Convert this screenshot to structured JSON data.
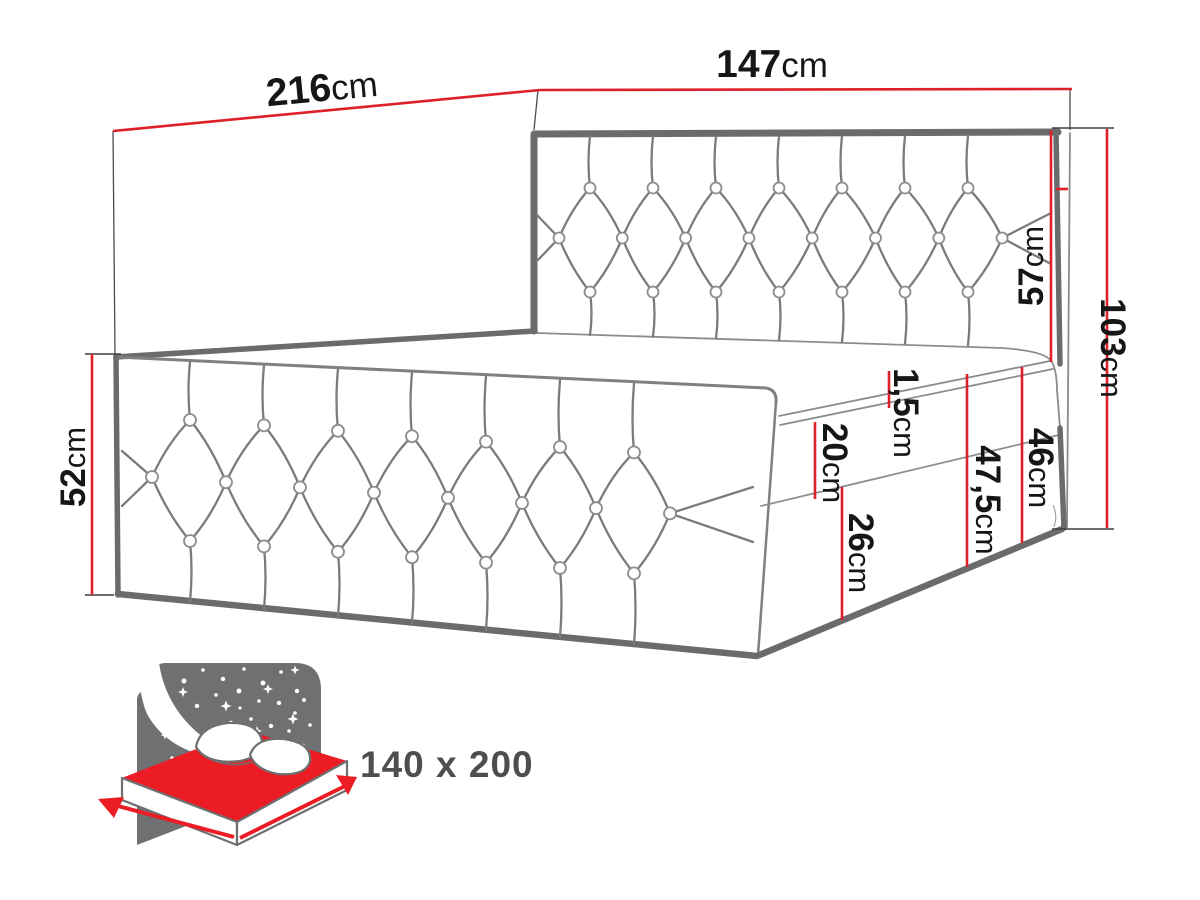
{
  "diagram": {
    "title": "bed-dimension-technical-drawing",
    "dims": {
      "d216": {
        "value": "216",
        "unit": "cm"
      },
      "d147": {
        "value": "147",
        "unit": "cm"
      },
      "d57": {
        "value": "57",
        "unit": "cm"
      },
      "d103": {
        "value": "103",
        "unit": "cm"
      },
      "d52": {
        "value": "52",
        "unit": "cm"
      },
      "d20": {
        "value": "20",
        "unit": "cm"
      },
      "d1_5": {
        "value": "1,5",
        "unit": "cm"
      },
      "d47_5": {
        "value": "47,5",
        "unit": "cm"
      },
      "d46": {
        "value": "46",
        "unit": "cm"
      },
      "d26": {
        "value": "26",
        "unit": "cm"
      }
    },
    "icon": {
      "size_label": "140 x 200"
    },
    "colors": {
      "dimension_red": "#de2129",
      "outline_gray": "#696b6d",
      "icon_gray": "#6e7072",
      "icon_red": "#ec1c24",
      "label_black": "#161616",
      "size_label_gray": "#4c4e50"
    }
  }
}
